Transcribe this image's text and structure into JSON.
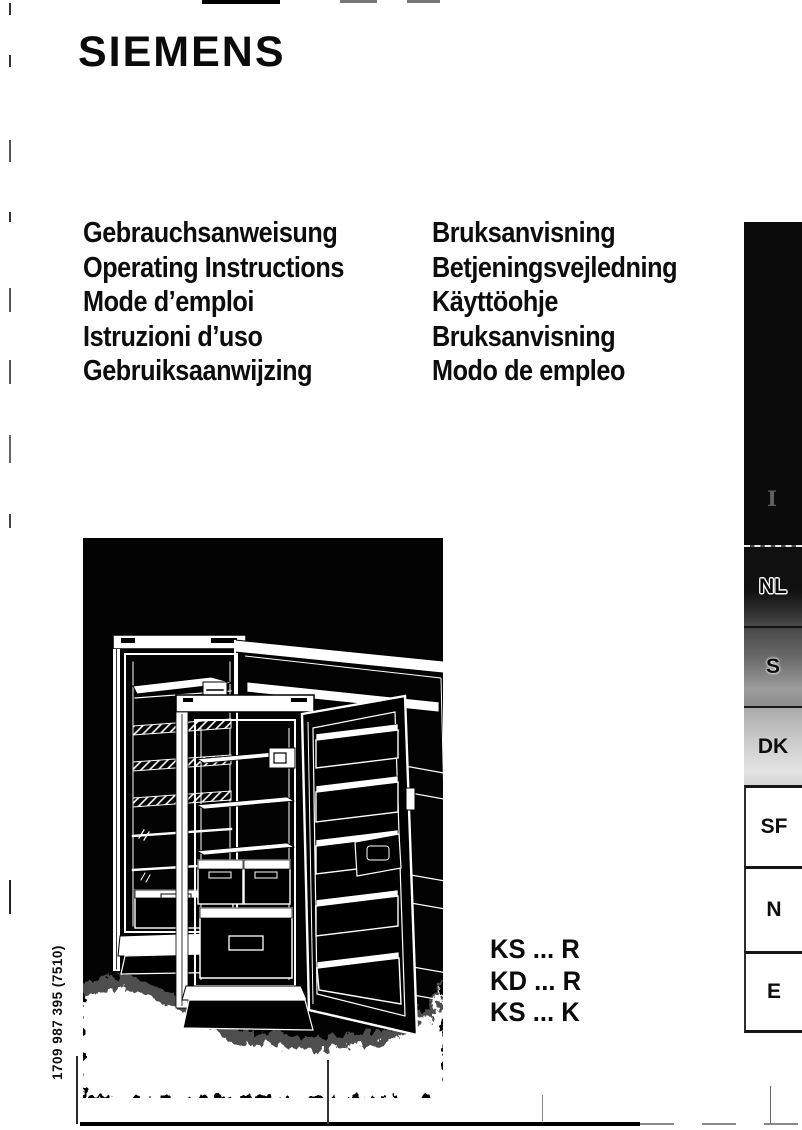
{
  "brand": {
    "logo": "SIEMENS"
  },
  "titles": {
    "left": [
      "Gebrauchsanweisung",
      "Operating Instructions",
      "Mode d’emploi",
      "Istruzioni d’uso",
      "Gebruiksaanwijzing"
    ],
    "right": [
      "Bruksanvisning",
      "Betjeningsvejledning",
      "Käyttöohje",
      "Bruksanvisning",
      "Modo de empleo"
    ]
  },
  "models": [
    "KS ... R",
    "KD ... R",
    "KS ... K"
  ],
  "order_number": "1709 987 395 (7510)",
  "sidebar": {
    "black_tab_label": "I",
    "tabs": [
      {
        "label": "NL"
      },
      {
        "label": "S"
      },
      {
        "label": "DK"
      },
      {
        "label": "SF"
      },
      {
        "label": "N"
      },
      {
        "label": "E"
      }
    ]
  },
  "colors": {
    "page": "#ffffff",
    "ink": "#111111",
    "illustration_background": "#000000",
    "tab_nl_background": "#101010",
    "tab_s_background": "#6c6c6c",
    "tab_dk_background": "#cdcdcd"
  }
}
